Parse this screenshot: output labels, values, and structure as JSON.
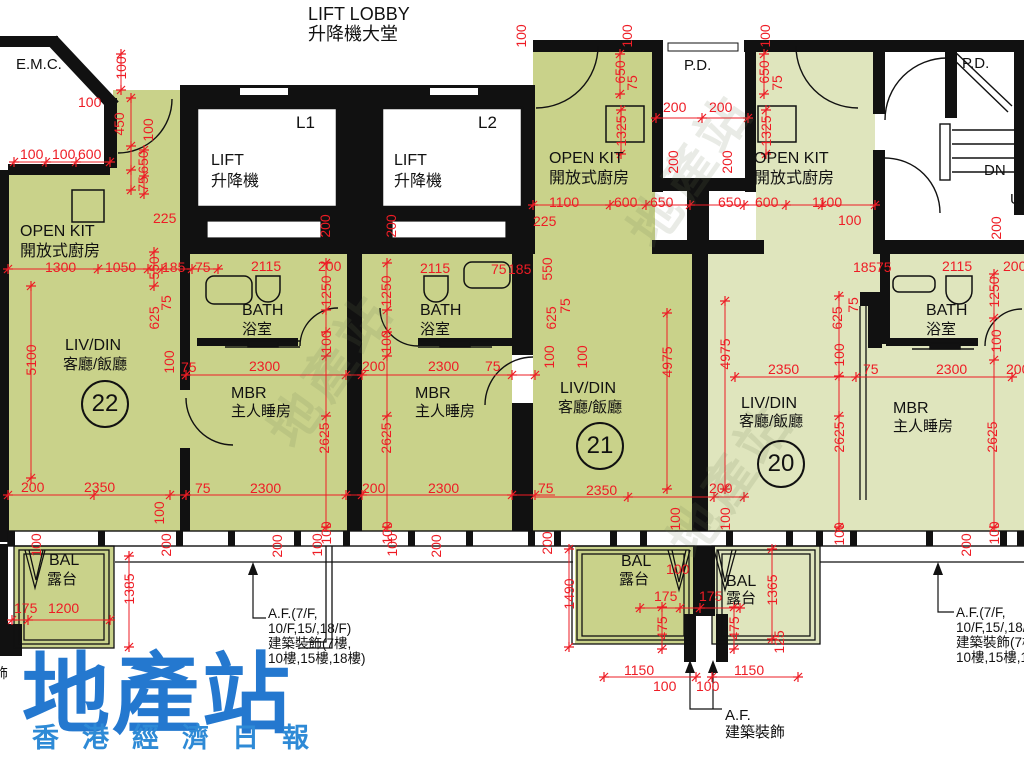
{
  "colors": {
    "dimension_red": "#ee1c25",
    "wall_black": "#111111",
    "unit_green_dark": "#c9d28a",
    "unit_green_light": "#dfe5bd",
    "watermark_blue": "#2478cf",
    "watermark_blue_sub": "#2e8ad6"
  },
  "header": {
    "title_en": "LIFT LOBBY",
    "title_zh": "升降機大堂"
  },
  "watermark": {
    "main": "地產站",
    "sub": "香港經濟日報",
    "diagonal": "地產站"
  },
  "units": [
    {
      "number": "22",
      "rooms": [
        "LIV/DIN 客廳/飯廳",
        "MBR 主人睡房",
        "BATH 浴室",
        "OPEN KIT 開放式廚房",
        "BAL 露台"
      ]
    },
    {
      "number": "21",
      "rooms": [
        "LIV/DIN 客廳/飯廳",
        "MBR 主人睡房",
        "BATH 浴室",
        "OPEN KIT 開放式廚房",
        "BAL 露台"
      ]
    },
    {
      "number": "20",
      "rooms": [
        "LIV/DIN 客廳/飯廳",
        "MBR 主人睡房",
        "BATH 浴室",
        "OPEN KIT 開放式廚房",
        "BAL 露台"
      ]
    }
  ],
  "annotations": {
    "af_side": [
      "A.F.(7/F,",
      "10/F,15/,18/F)",
      "建築裝飾(7樓,",
      "10樓,15樓,18樓)"
    ],
    "af_bottom": [
      "A.F.",
      "建築裝飾"
    ]
  },
  "labels": [
    {
      "n": "room-emc",
      "t": "E.M.C.",
      "x": 16,
      "y": 57,
      "s": 15,
      "c": "k"
    },
    {
      "n": "lift1-id",
      "t": "L1",
      "x": 296,
      "y": 114,
      "s": 17,
      "c": "k"
    },
    {
      "n": "lift1-en",
      "t": "LIFT",
      "x": 211,
      "y": 153,
      "s": 16,
      "c": "k"
    },
    {
      "n": "lift1-zh",
      "t": "升降機",
      "x": 211,
      "y": 174,
      "s": 16,
      "c": "k"
    },
    {
      "n": "lift2-id",
      "t": "L2",
      "x": 478,
      "y": 114,
      "s": 17,
      "c": "k"
    },
    {
      "n": "lift2-en",
      "t": "LIFT",
      "x": 394,
      "y": 153,
      "s": 16,
      "c": "k"
    },
    {
      "n": "lift2-zh",
      "t": "升降機",
      "x": 394,
      "y": 174,
      "s": 16,
      "c": "k"
    },
    {
      "n": "openkit-22-en",
      "t": "OPEN KIT",
      "x": 20,
      "y": 224,
      "s": 16,
      "c": "k"
    },
    {
      "n": "openkit-22-zh",
      "t": "開放式廚房",
      "x": 20,
      "y": 244,
      "s": 16,
      "c": "k"
    },
    {
      "n": "pd-left",
      "t": "P.D.",
      "x": 684,
      "y": 58,
      "s": 15,
      "c": "k"
    },
    {
      "n": "openkit-21-en",
      "t": "OPEN KIT",
      "x": 549,
      "y": 151,
      "s": 16,
      "c": "k"
    },
    {
      "n": "openkit-21-zh",
      "t": "開放式廚房",
      "x": 549,
      "y": 171,
      "s": 16,
      "c": "k"
    },
    {
      "n": "openkit-20-en",
      "t": "OPEN KIT",
      "x": 754,
      "y": 151,
      "s": 16,
      "c": "k"
    },
    {
      "n": "openkit-20-zh",
      "t": "開放式廚房",
      "x": 754,
      "y": 171,
      "s": 16,
      "c": "k"
    },
    {
      "n": "pd-right",
      "t": "P.D.",
      "x": 962,
      "y": 56,
      "s": 15,
      "c": "k"
    },
    {
      "n": "stair-dn",
      "t": "DN",
      "x": 984,
      "y": 163,
      "s": 15,
      "c": "k"
    },
    {
      "n": "stair-up",
      "t": "UP",
      "x": 1010,
      "y": 192,
      "s": 15,
      "c": "k"
    },
    {
      "n": "livdin-22-en",
      "t": "LIV/DIN",
      "x": 65,
      "y": 338,
      "s": 16,
      "c": "k"
    },
    {
      "n": "livdin-22-zh",
      "t": "客廳/飯廳",
      "x": 63,
      "y": 357,
      "s": 15,
      "c": "k"
    },
    {
      "n": "bath-22-en",
      "t": "BATH",
      "x": 242,
      "y": 303,
      "s": 16,
      "c": "k"
    },
    {
      "n": "bath-22-zh",
      "t": "浴室",
      "x": 242,
      "y": 322,
      "s": 15,
      "c": "k"
    },
    {
      "n": "mbr-22-en",
      "t": "MBR",
      "x": 231,
      "y": 386,
      "s": 16,
      "c": "k"
    },
    {
      "n": "mbr-22-zh",
      "t": "主人睡房",
      "x": 231,
      "y": 404,
      "s": 15,
      "c": "k"
    },
    {
      "n": "bath-21-en",
      "t": "BATH",
      "x": 420,
      "y": 303,
      "s": 16,
      "c": "k"
    },
    {
      "n": "bath-21-zh",
      "t": "浴室",
      "x": 420,
      "y": 322,
      "s": 15,
      "c": "k"
    },
    {
      "n": "mbr-21-en",
      "t": "MBR",
      "x": 415,
      "y": 386,
      "s": 16,
      "c": "k"
    },
    {
      "n": "mbr-21-zh",
      "t": "主人睡房",
      "x": 415,
      "y": 404,
      "s": 15,
      "c": "k"
    },
    {
      "n": "livdin-21-en",
      "t": "LIV/DIN",
      "x": 560,
      "y": 381,
      "s": 16,
      "c": "k"
    },
    {
      "n": "livdin-21-zh",
      "t": "客廳/飯廳",
      "x": 558,
      "y": 400,
      "s": 15,
      "c": "k"
    },
    {
      "n": "livdin-20-en",
      "t": "LIV/DIN",
      "x": 741,
      "y": 396,
      "s": 16,
      "c": "k"
    },
    {
      "n": "livdin-20-zh",
      "t": "客廳/飯廳",
      "x": 739,
      "y": 414,
      "s": 15,
      "c": "k"
    },
    {
      "n": "mbr-20-en",
      "t": "MBR",
      "x": 893,
      "y": 401,
      "s": 16,
      "c": "k"
    },
    {
      "n": "mbr-20-zh",
      "t": "主人睡房",
      "x": 893,
      "y": 419,
      "s": 15,
      "c": "k"
    },
    {
      "n": "bath-20-en",
      "t": "BATH",
      "x": 926,
      "y": 303,
      "s": 16,
      "c": "k"
    },
    {
      "n": "bath-20-zh",
      "t": "浴室",
      "x": 926,
      "y": 322,
      "s": 15,
      "c": "k"
    },
    {
      "n": "bal-22-en",
      "t": "BAL",
      "x": 49,
      "y": 553,
      "s": 16,
      "c": "k"
    },
    {
      "n": "bal-22-zh",
      "t": "露台",
      "x": 47,
      "y": 572,
      "s": 15,
      "c": "k"
    },
    {
      "n": "bal-21-en",
      "t": "BAL",
      "x": 621,
      "y": 554,
      "s": 16,
      "c": "k"
    },
    {
      "n": "bal-21-zh",
      "t": "露台",
      "x": 619,
      "y": 572,
      "s": 15,
      "c": "k"
    },
    {
      "n": "bal-20-en",
      "t": "BAL",
      "x": 726,
      "y": 574,
      "s": 16,
      "c": "k"
    },
    {
      "n": "bal-20-zh",
      "t": "露台",
      "x": 726,
      "y": 591,
      "s": 15,
      "c": "k"
    },
    {
      "n": "af-left-1",
      "t": "A.F.(7/F,",
      "x": 268,
      "y": 607,
      "s": 13.5,
      "c": "k"
    },
    {
      "n": "af-left-2",
      "t": "10/F,15/,18/F)",
      "x": 268,
      "y": 622,
      "s": 13.5,
      "c": "k"
    },
    {
      "n": "af-left-3",
      "t": "建築裝飾(7樓,",
      "x": 268,
      "y": 637,
      "s": 13.5,
      "c": "k"
    },
    {
      "n": "af-left-4",
      "t": "10樓,15樓,18樓)",
      "x": 268,
      "y": 652,
      "s": 13.5,
      "c": "k"
    },
    {
      "n": "af-right-1",
      "t": "A.F.(7/F,",
      "x": 956,
      "y": 606,
      "s": 13.5,
      "c": "k"
    },
    {
      "n": "af-right-2",
      "t": "10/F,15/,18/F)",
      "x": 956,
      "y": 621,
      "s": 13.5,
      "c": "k"
    },
    {
      "n": "af-right-3",
      "t": "建築裝飾(7樓,",
      "x": 956,
      "y": 636,
      "s": 13.5,
      "c": "k"
    },
    {
      "n": "af-right-4",
      "t": "10樓,15樓,18樓)",
      "x": 956,
      "y": 651,
      "s": 13.5,
      "c": "k"
    },
    {
      "n": "af-bottom-1",
      "t": "A.F.",
      "x": 725,
      "y": 708,
      "s": 15,
      "c": "k"
    },
    {
      "n": "af-bottom-2",
      "t": "建築裝飾",
      "x": 725,
      "y": 725,
      "s": 15,
      "c": "k"
    },
    {
      "n": "clipped-char",
      "t": "飾",
      "x": -6,
      "y": 666,
      "s": 14,
      "c": "k"
    },
    {
      "n": "unit-22-number",
      "t": "22",
      "x": 105,
      "y": 404,
      "cls": "circle"
    },
    {
      "n": "unit-21-number",
      "t": "21",
      "x": 600,
      "y": 446,
      "cls": "circle"
    },
    {
      "n": "unit-20-number",
      "t": "20",
      "x": 781,
      "y": 464,
      "cls": "circle"
    },
    {
      "n": "dim-100",
      "t": "100",
      "x": 121,
      "y": 68,
      "r": 1
    },
    {
      "n": "dim-100",
      "t": "100",
      "x": 78,
      "y": 95
    },
    {
      "n": "dim-450",
      "t": "450",
      "x": 119,
      "y": 124,
      "r": 1
    },
    {
      "n": "dim-100",
      "t": "100",
      "x": 148,
      "y": 130,
      "r": 1
    },
    {
      "n": "dim-100",
      "t": "100",
      "x": 20,
      "y": 147
    },
    {
      "n": "dim-100",
      "t": "100",
      "x": 52,
      "y": 147
    },
    {
      "n": "dim-600",
      "t": "600",
      "x": 78,
      "y": 147
    },
    {
      "n": "dim-650",
      "t": "650",
      "x": 143,
      "y": 162,
      "r": 1
    },
    {
      "n": "dim-75",
      "t": "75",
      "x": 143,
      "y": 184,
      "r": 1
    },
    {
      "n": "dim-225",
      "t": "225",
      "x": 153,
      "y": 211
    },
    {
      "n": "dim-1300",
      "t": "1300",
      "x": 45,
      "y": 260
    },
    {
      "n": "dim-1050",
      "t": "1050",
      "x": 105,
      "y": 260
    },
    {
      "n": "dim-550",
      "t": "550",
      "x": 154,
      "y": 268,
      "r": 1
    },
    {
      "n": "dim-185",
      "t": "185",
      "x": 162,
      "y": 260
    },
    {
      "n": "dim-75",
      "t": "75",
      "x": 195,
      "y": 260
    },
    {
      "n": "dim-200",
      "t": "200",
      "x": 325,
      "y": 226,
      "r": 1
    },
    {
      "n": "dim-200",
      "t": "200",
      "x": 391,
      "y": 226,
      "r": 1
    },
    {
      "n": "dim-100",
      "t": "100",
      "x": 521,
      "y": 36,
      "r": 1
    },
    {
      "n": "dim-100",
      "t": "100",
      "x": 627,
      "y": 36,
      "r": 1
    },
    {
      "n": "dim-100",
      "t": "100",
      "x": 765,
      "y": 36,
      "r": 1
    },
    {
      "n": "dim-650",
      "t": "650",
      "x": 620,
      "y": 72,
      "r": 1
    },
    {
      "n": "dim-75",
      "t": "75",
      "x": 632,
      "y": 83,
      "r": 1
    },
    {
      "n": "dim-650",
      "t": "650",
      "x": 764,
      "y": 72,
      "r": 1
    },
    {
      "n": "dim-75",
      "t": "75",
      "x": 777,
      "y": 83,
      "r": 1
    },
    {
      "n": "dim-1325",
      "t": "1325",
      "x": 621,
      "y": 131,
      "r": 1
    },
    {
      "n": "dim-1325",
      "t": "1325",
      "x": 766,
      "y": 131,
      "r": 1
    },
    {
      "n": "dim-200",
      "t": "200",
      "x": 663,
      "y": 100
    },
    {
      "n": "dim-200",
      "t": "200",
      "x": 709,
      "y": 100
    },
    {
      "n": "dim-200",
      "t": "200",
      "x": 673,
      "y": 162,
      "r": 1
    },
    {
      "n": "dim-200",
      "t": "200",
      "x": 727,
      "y": 162,
      "r": 1
    },
    {
      "n": "dim-1100",
      "t": "1100",
      "x": 549,
      "y": 195
    },
    {
      "n": "dim-600",
      "t": "600",
      "x": 614,
      "y": 195
    },
    {
      "n": "dim-650",
      "t": "650",
      "x": 650,
      "y": 195
    },
    {
      "n": "dim-650",
      "t": "650",
      "x": 718,
      "y": 195
    },
    {
      "n": "dim-600",
      "t": "600",
      "x": 755,
      "y": 195
    },
    {
      "n": "dim-1100",
      "t": "1100",
      "x": 812,
      "y": 195
    },
    {
      "n": "dim-225",
      "t": "225",
      "x": 533,
      "y": 214
    },
    {
      "n": "dim-100",
      "t": "100",
      "x": 838,
      "y": 213
    },
    {
      "n": "dim-200",
      "t": "200",
      "x": 996,
      "y": 228,
      "r": 1
    },
    {
      "n": "dim-5100",
      "t": "5100",
      "x": 31,
      "y": 360,
      "r": 1
    },
    {
      "n": "dim-625",
      "t": "625",
      "x": 154,
      "y": 318,
      "r": 1
    },
    {
      "n": "dim-75",
      "t": "75",
      "x": 166,
      "y": 303,
      "r": 1
    },
    {
      "n": "dim-100",
      "t": "100",
      "x": 169,
      "y": 362,
      "r": 1
    },
    {
      "n": "dim-75",
      "t": "75",
      "x": 181,
      "y": 360
    },
    {
      "n": "dim-2115",
      "t": "2115",
      "x": 251,
      "y": 259
    },
    {
      "n": "dim-200",
      "t": "200",
      "x": 318,
      "y": 259
    },
    {
      "n": "dim-1250",
      "t": "1250",
      "x": 326,
      "y": 291,
      "r": 1
    },
    {
      "n": "dim-100",
      "t": "100",
      "x": 326,
      "y": 342,
      "r": 1
    },
    {
      "n": "dim-2300",
      "t": "2300",
      "x": 249,
      "y": 359
    },
    {
      "n": "dim-2625",
      "t": "2625",
      "x": 324,
      "y": 438,
      "r": 1
    },
    {
      "n": "dim-75",
      "t": "75",
      "x": 195,
      "y": 481
    },
    {
      "n": "dim-2300",
      "t": "2300",
      "x": 250,
      "y": 481
    },
    {
      "n": "dim-200",
      "t": "200",
      "x": 21,
      "y": 480
    },
    {
      "n": "dim-2350",
      "t": "2350",
      "x": 84,
      "y": 480
    },
    {
      "n": "dim-100",
      "t": "100",
      "x": 36,
      "y": 545,
      "r": 1
    },
    {
      "n": "dim-100",
      "t": "100",
      "x": 159,
      "y": 513,
      "r": 1
    },
    {
      "n": "dim-200",
      "t": "200",
      "x": 166,
      "y": 545,
      "r": 1
    },
    {
      "n": "dim-1250",
      "t": "1250",
      "x": 386,
      "y": 291,
      "r": 1
    },
    {
      "n": "dim-100",
      "t": "100",
      "x": 386,
      "y": 342,
      "r": 1
    },
    {
      "n": "dim-200",
      "t": "200",
      "x": 362,
      "y": 359
    },
    {
      "n": "dim-2300",
      "t": "2300",
      "x": 428,
      "y": 359
    },
    {
      "n": "dim-75",
      "t": "75",
      "x": 485,
      "y": 359
    },
    {
      "n": "dim-2115",
      "t": "2115",
      "x": 420,
      "y": 261
    },
    {
      "n": "dim-75",
      "t": "75",
      "x": 491,
      "y": 262
    },
    {
      "n": "dim-185",
      "t": "185",
      "x": 508,
      "y": 262
    },
    {
      "n": "dim-550",
      "t": "550",
      "x": 547,
      "y": 269,
      "r": 1
    },
    {
      "n": "dim-625",
      "t": "625",
      "x": 551,
      "y": 318,
      "r": 1
    },
    {
      "n": "dim-75",
      "t": "75",
      "x": 565,
      "y": 306,
      "r": 1
    },
    {
      "n": "dim-100",
      "t": "100",
      "x": 549,
      "y": 357,
      "r": 1
    },
    {
      "n": "dim-100",
      "t": "100",
      "x": 582,
      "y": 357,
      "r": 1
    },
    {
      "n": "dim-2625",
      "t": "2625",
      "x": 386,
      "y": 438,
      "r": 1
    },
    {
      "n": "dim-200",
      "t": "200",
      "x": 362,
      "y": 481
    },
    {
      "n": "dim-2300",
      "t": "2300",
      "x": 428,
      "y": 481
    },
    {
      "n": "dim-75",
      "t": "75",
      "x": 538,
      "y": 481
    },
    {
      "n": "dim-2350",
      "t": "2350",
      "x": 586,
      "y": 483
    },
    {
      "n": "dim-200",
      "t": "200",
      "x": 709,
      "y": 481
    },
    {
      "n": "dim-4975",
      "t": "4975",
      "x": 667,
      "y": 362,
      "r": 1
    },
    {
      "n": "dim-4975",
      "t": "4975",
      "x": 725,
      "y": 354,
      "r": 1
    },
    {
      "n": "dim-100",
      "t": "100",
      "x": 675,
      "y": 519,
      "r": 1
    },
    {
      "n": "dim-100",
      "t": "100",
      "x": 725,
      "y": 519,
      "r": 1
    },
    {
      "n": "dim-200",
      "t": "200",
      "x": 547,
      "y": 543,
      "r": 1
    },
    {
      "n": "dim-100",
      "t": "100",
      "x": 326,
      "y": 533,
      "r": 1
    },
    {
      "n": "dim-100",
      "t": "100",
      "x": 387,
      "y": 533,
      "r": 1
    },
    {
      "n": "dim-625",
      "t": "625",
      "x": 837,
      "y": 318,
      "r": 1
    },
    {
      "n": "dim-75",
      "t": "75",
      "x": 853,
      "y": 305,
      "r": 1
    },
    {
      "n": "dim-100",
      "t": "100",
      "x": 839,
      "y": 355,
      "r": 1
    },
    {
      "n": "dim-2350",
      "t": "2350",
      "x": 768,
      "y": 362
    },
    {
      "n": "dim-75",
      "t": "75",
      "x": 863,
      "y": 362
    },
    {
      "n": "dim-2300",
      "t": "2300",
      "x": 936,
      "y": 362
    },
    {
      "n": "dim-200",
      "t": "200",
      "x": 1006,
      "y": 362
    },
    {
      "n": "dim-185",
      "t": "185",
      "x": 853,
      "y": 260
    },
    {
      "n": "dim-75",
      "t": "75",
      "x": 876,
      "y": 260
    },
    {
      "n": "dim-2115",
      "t": "2115",
      "x": 942,
      "y": 259
    },
    {
      "n": "dim-200",
      "t": "200",
      "x": 1003,
      "y": 259
    },
    {
      "n": "dim-1250",
      "t": "1250",
      "x": 994,
      "y": 292,
      "r": 1
    },
    {
      "n": "dim-100",
      "t": "100",
      "x": 996,
      "y": 341,
      "r": 1
    },
    {
      "n": "dim-2625",
      "t": "2625",
      "x": 839,
      "y": 437,
      "r": 1
    },
    {
      "n": "dim-2625",
      "t": "2625",
      "x": 992,
      "y": 437,
      "r": 1
    },
    {
      "n": "dim-100",
      "t": "100",
      "x": 839,
      "y": 534,
      "r": 1
    },
    {
      "n": "dim-200",
      "t": "200",
      "x": 966,
      "y": 545,
      "r": 1
    },
    {
      "n": "dim-100",
      "t": "100",
      "x": 994,
      "y": 533,
      "r": 1
    },
    {
      "n": "dim-1385",
      "t": "1385",
      "x": 129,
      "y": 589,
      "r": 1
    },
    {
      "n": "dim-175",
      "t": "175",
      "x": 14,
      "y": 601
    },
    {
      "n": "dim-1200",
      "t": "1200",
      "x": 48,
      "y": 601
    },
    {
      "n": "dim-1490",
      "t": "1490",
      "x": 569,
      "y": 594,
      "r": 1
    },
    {
      "n": "dim-100",
      "t": "100",
      "x": 666,
      "y": 562
    },
    {
      "n": "dim-175",
      "t": "175",
      "x": 654,
      "y": 589
    },
    {
      "n": "dim-175",
      "t": "175",
      "x": 699,
      "y": 589
    },
    {
      "n": "dim-475",
      "t": "475",
      "x": 662,
      "y": 628,
      "r": 1
    },
    {
      "n": "dim-475",
      "t": "475",
      "x": 734,
      "y": 628,
      "r": 1
    },
    {
      "n": "dim-1365",
      "t": "1365",
      "x": 772,
      "y": 590,
      "r": 1
    },
    {
      "n": "dim-125",
      "t": "125",
      "x": 779,
      "y": 642,
      "r": 1
    },
    {
      "n": "dim-1150",
      "t": "1150",
      "x": 624,
      "y": 663
    },
    {
      "n": "dim-1150",
      "t": "1150",
      "x": 734,
      "y": 663
    },
    {
      "n": "dim-100",
      "t": "100",
      "x": 653,
      "y": 679
    },
    {
      "n": "dim-100",
      "t": "100",
      "x": 696,
      "y": 679
    },
    {
      "n": "dim-200",
      "t": "200",
      "x": 277,
      "y": 546,
      "r": 1
    },
    {
      "n": "dim-100",
      "t": "100",
      "x": 317,
      "y": 545,
      "r": 1
    },
    {
      "n": "dim-100",
      "t": "100",
      "x": 392,
      "y": 545,
      "r": 1
    },
    {
      "n": "dim-200",
      "t": "200",
      "x": 436,
      "y": 546,
      "r": 1
    }
  ]
}
